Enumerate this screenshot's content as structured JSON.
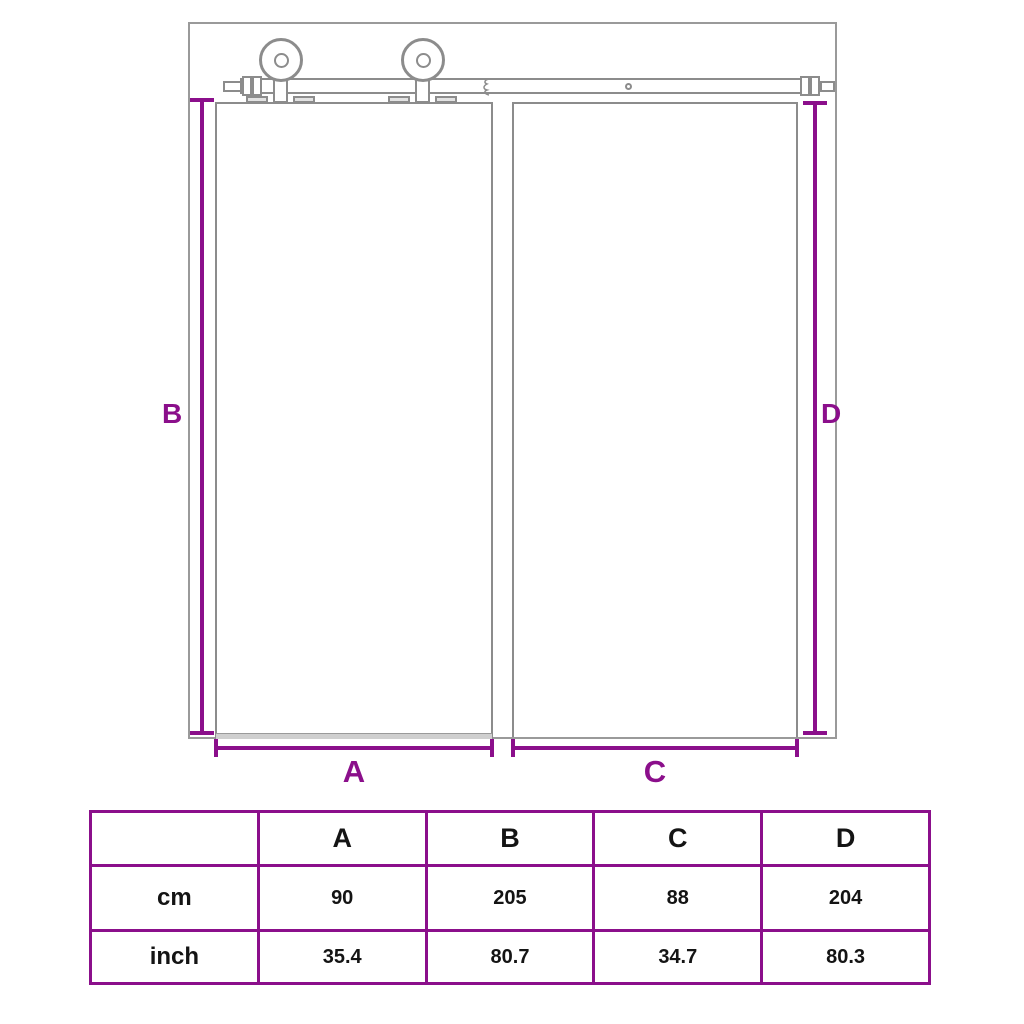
{
  "colors": {
    "accent": "#8B0F8B",
    "outline_gray": "#8C8C8C"
  },
  "diagram": {
    "labels": {
      "a": "A",
      "b": "B",
      "c": "C",
      "d": "D"
    }
  },
  "table": {
    "header": {
      "unit_col": "",
      "a": "A",
      "b": "B",
      "c": "C",
      "d": "D"
    },
    "rows": [
      {
        "unit": "cm",
        "a": "90",
        "b": "205",
        "c": "88",
        "d": "204"
      },
      {
        "unit": "inch",
        "a": "35.4",
        "b": "80.7",
        "c": "34.7",
        "d": "80.3"
      }
    ]
  }
}
